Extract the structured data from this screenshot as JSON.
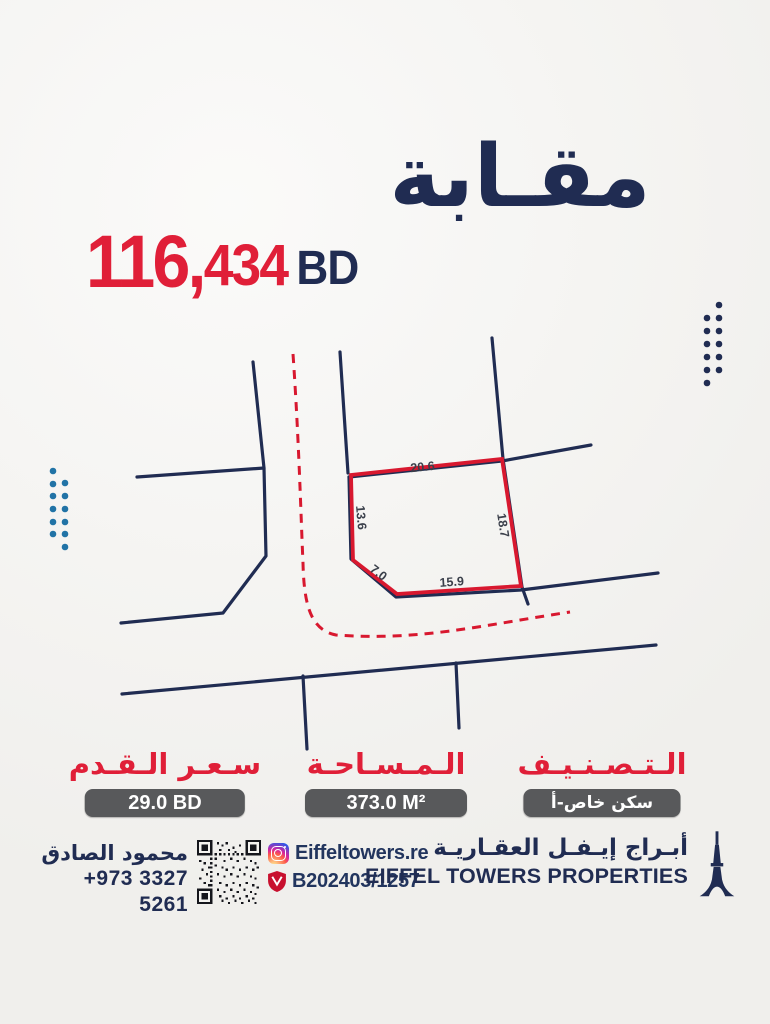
{
  "header": {
    "location_ar": "مقـابة",
    "price_amount_large": "116,",
    "price_amount_small": "434",
    "price_currency": "BD"
  },
  "map": {
    "dimensions": {
      "top": "20.6",
      "left": "13.6",
      "right": "18.7",
      "bottom": "15.9",
      "corner": "7.0"
    }
  },
  "details": [
    {
      "label": "الـتـصـنـيـف",
      "value": "سكن خاص-أ"
    },
    {
      "label": "الـمـسـاحـة",
      "value": "373.0 M²"
    },
    {
      "label": "سـعـر الـقـدم",
      "value": "29.0 BD"
    }
  ],
  "footer": {
    "agent_name": "محمود الصادق",
    "agent_phone": "+973 3327 5261",
    "instagram_handle": "Eiffeltowers.re",
    "license_number": "B202403/1257",
    "company_name_ar": "أبـراج إيـفـل العقـاريـة",
    "company_name_en": "EIFFEL TOWERS PROPERTIES"
  },
  "colors": {
    "navy": "#202c52",
    "accent_red": "#e01f38",
    "map_red": "#d8182f",
    "pill_gray": "#58595b",
    "dot_blue": "#2173a6"
  }
}
